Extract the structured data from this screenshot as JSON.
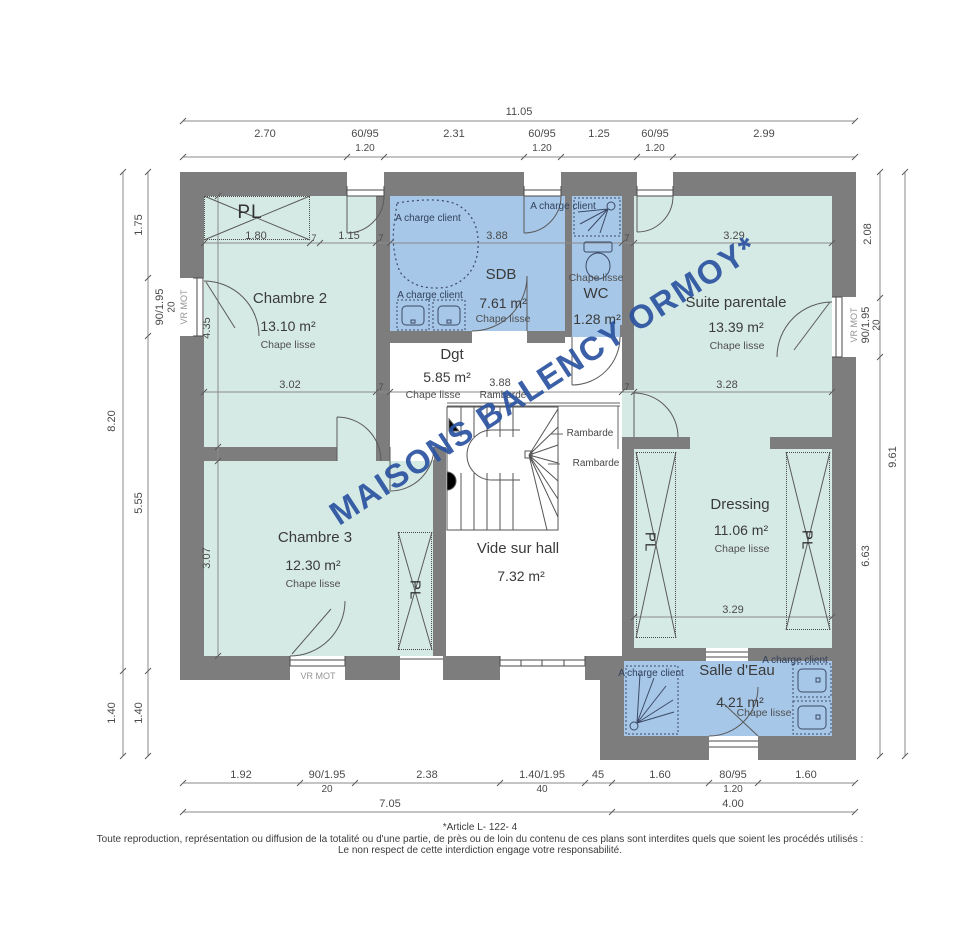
{
  "plan": {
    "watermark": "MAISONS BALENCY ORMOY*",
    "rooms": {
      "chambre2": {
        "name": "Chambre 2",
        "area": "13.10 m²",
        "floor": "Chape lisse"
      },
      "sdb": {
        "name": "SDB",
        "area": "7.61 m²",
        "floor": "Chape lisse"
      },
      "wc": {
        "name": "WC",
        "area": "1.28 m²",
        "floor": "Chape lisse"
      },
      "suite": {
        "name": "Suite parentale",
        "area": "13.39 m²",
        "floor": "Chape lisse"
      },
      "dgt": {
        "name": "Dgt",
        "area": "5.85 m²",
        "floor": "Chape lisse"
      },
      "chambre3": {
        "name": "Chambre 3",
        "area": "12.30 m²",
        "floor": "Chape lisse"
      },
      "vide": {
        "name": "Vide sur hall",
        "area": "7.32 m²"
      },
      "dressing": {
        "name": "Dressing",
        "area": "11.06 m²",
        "floor": "Chape lisse"
      },
      "salle_eau": {
        "name": "Salle d'Eau",
        "area": "4.21 m²",
        "floor": "Chape lisse"
      }
    },
    "labels": {
      "closet": "PL",
      "client": "A charge client",
      "railing": "Rambarde",
      "shutter": "VR MOT"
    },
    "dims": {
      "top": [
        "11.05",
        "2.70",
        "60/95",
        "1.20",
        "2.31",
        "60/95",
        "1.20",
        "1.25",
        "60/95",
        "1.20",
        "2.99"
      ],
      "inner_top": [
        "1.80",
        "7",
        "1.15",
        "7",
        "3.88",
        "7",
        "3.29"
      ],
      "inner_mid": [
        "3.02",
        "7",
        "3.88",
        "7",
        "3.28"
      ],
      "dressing": "3.29",
      "left": [
        "8.20",
        "1.40",
        "1.75",
        "90/1.95",
        "20",
        "VR MOT",
        "5.55",
        "1.40"
      ],
      "left_inner": [
        "4.35",
        "3.07"
      ],
      "right": [
        "2.08",
        "90/1.95",
        "20",
        "VR MOT",
        "6.63",
        "9.61"
      ],
      "bottom": [
        "1.92",
        "90/1.95",
        "20",
        "2.38",
        "1.40/1.95",
        "40",
        "45",
        "1.60",
        "80/95",
        "1.20",
        "1.60",
        "7.05",
        "4.00"
      ]
    },
    "footer": {
      "article": "*Article L- 122- 4",
      "line1": "Toute reproduction, représentation ou diffusion de la totalité ou d'une partie, de près ou de loin du contenu de ces plans sont interdites quels que soient  les procédés utilisés :",
      "line2": "Le non respect de cette interdiction engage votre responsabilité."
    },
    "colors": {
      "wall": "#7d7d7d",
      "room_dry": "#d6eae5",
      "room_wet": "#a6c7e8",
      "watermark": "#2b53a0"
    }
  }
}
